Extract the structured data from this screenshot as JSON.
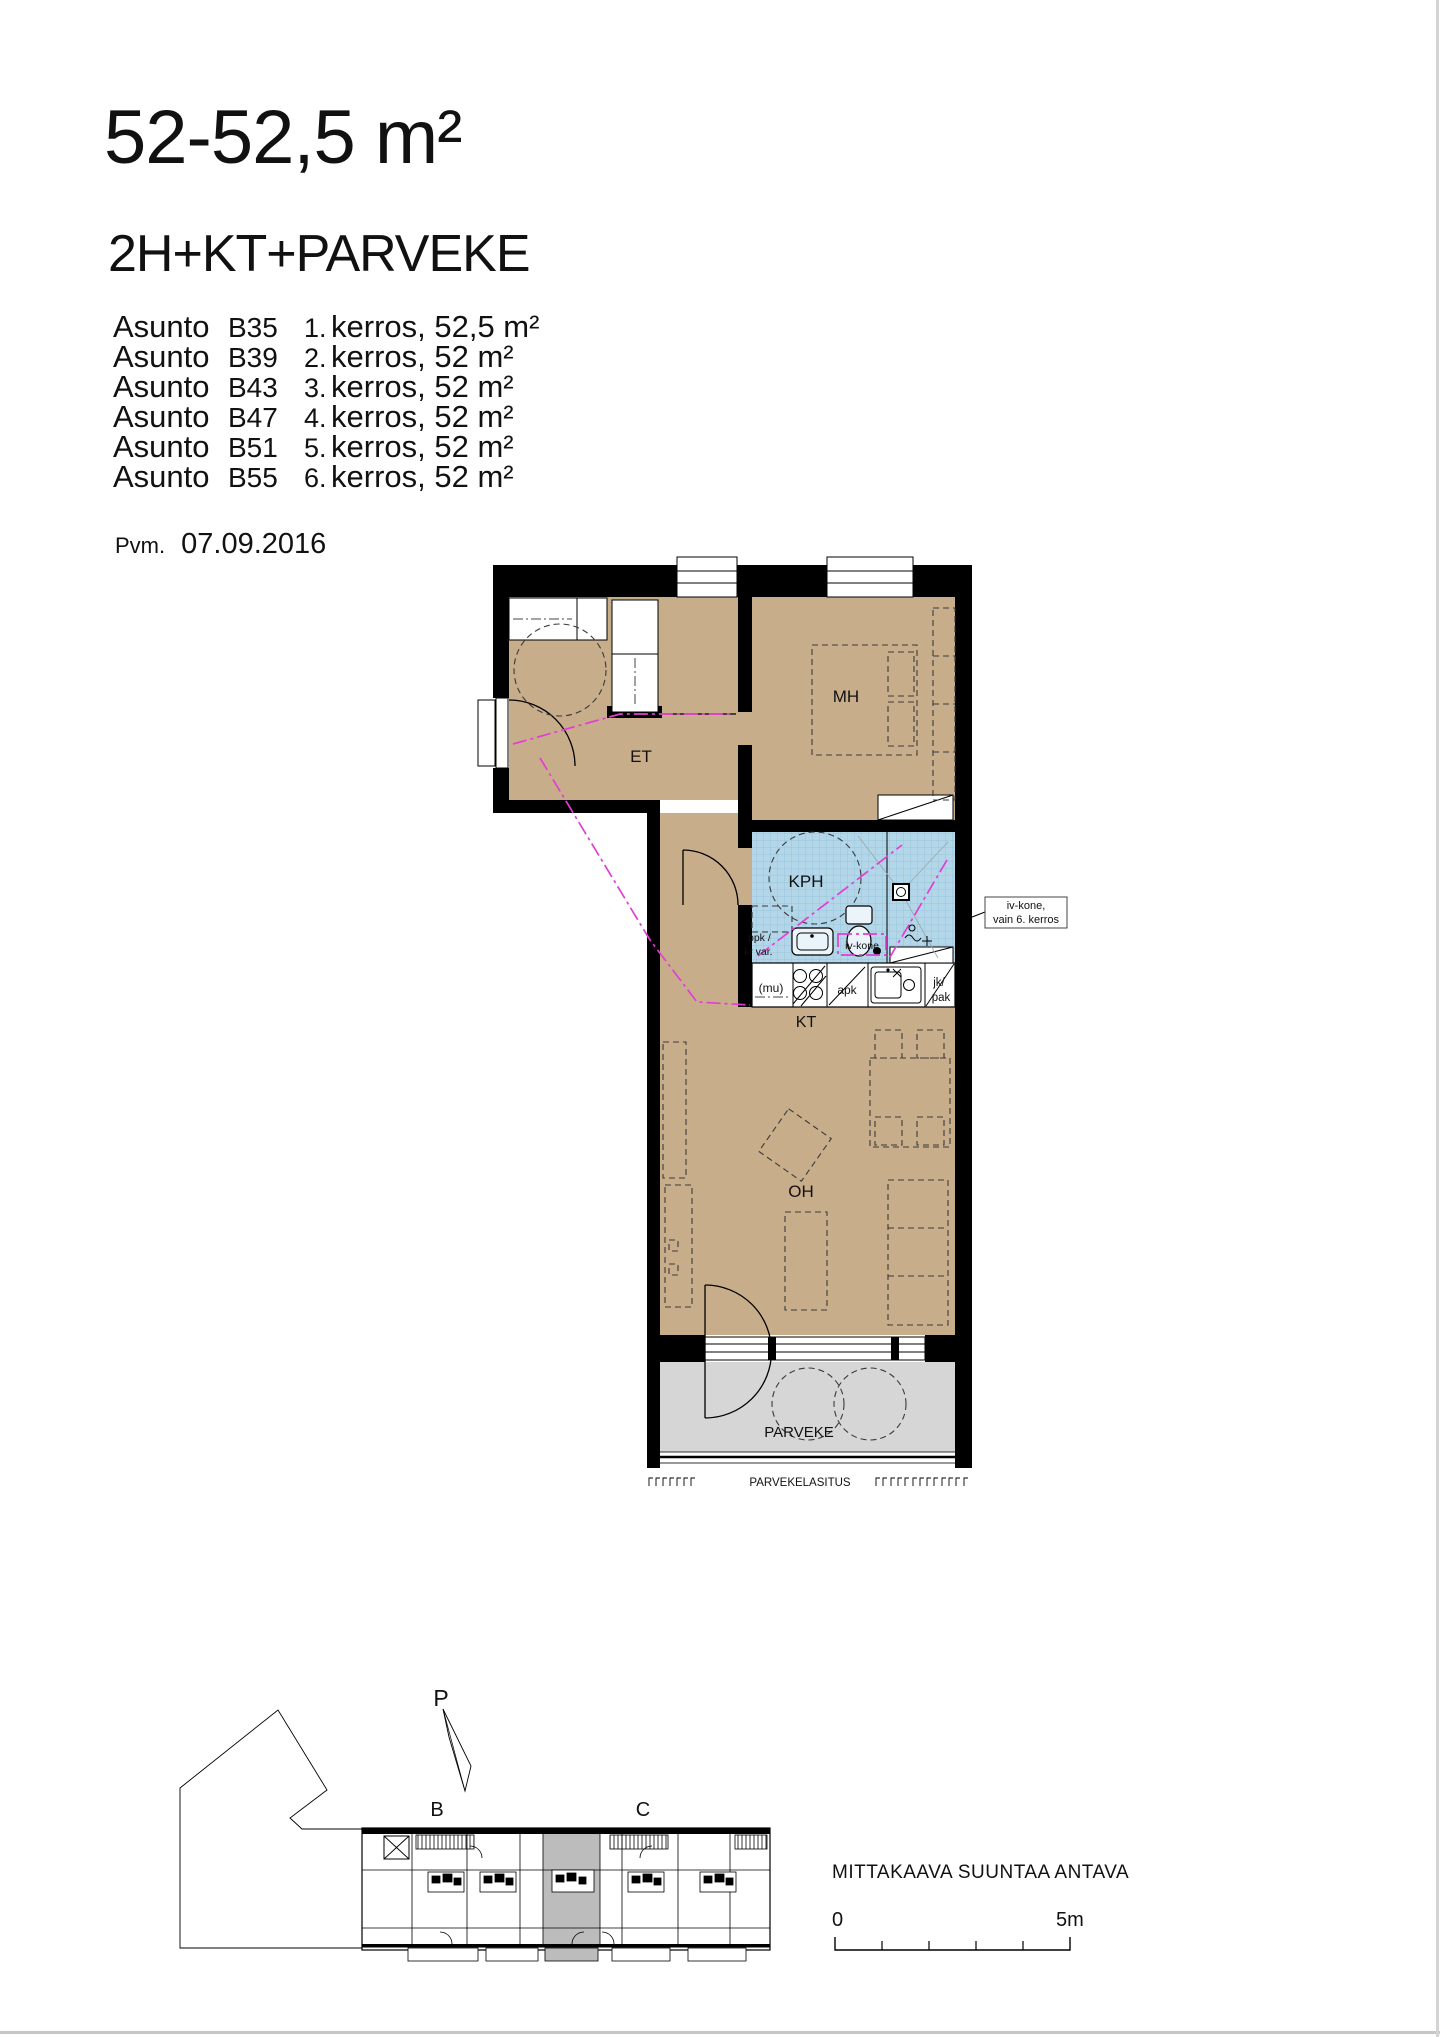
{
  "header": {
    "title": "52-52,5 m²",
    "subtitle": "2H+KT+PARVEKE",
    "list_label": "Asunto",
    "apartments": [
      {
        "unit": "B35",
        "floor": "1.",
        "desc": "kerros, 52,5 m²"
      },
      {
        "unit": "B39",
        "floor": "2.",
        "desc": "kerros, 52 m²"
      },
      {
        "unit": "B43",
        "floor": "3.",
        "desc": "kerros, 52 m²"
      },
      {
        "unit": "B47",
        "floor": "4.",
        "desc": "kerros, 52 m²"
      },
      {
        "unit": "B51",
        "floor": "5.",
        "desc": "kerros, 52 m²"
      },
      {
        "unit": "B55",
        "floor": "6.",
        "desc": "kerros, 52 m²"
      }
    ],
    "date_label": "Pvm.",
    "date": "07.09.2016"
  },
  "plan": {
    "rooms": {
      "et": "ET",
      "mh": "MH",
      "kph": "KPH",
      "kt": "KT",
      "oh": "OH",
      "parveke": "PARVEKE"
    },
    "fixtures": {
      "ppk1": "ppk /",
      "ppk2": "kr var.",
      "iv": "iv-kone",
      "mu": "(mu)",
      "apk": "apk",
      "jk1": "jk/",
      "jk2": "pak"
    },
    "glazing": "PARVEKELASITUS",
    "annotation": {
      "line1": "iv-kone,",
      "line2": "vain 6. kerros"
    }
  },
  "site": {
    "north": "P",
    "building_b": "B",
    "building_c": "C",
    "scale_note": "MITTAKAAVA SUUNTAA ANTAVA",
    "scale_zero": "0",
    "scale_five": "5m"
  },
  "colors": {
    "room": "#c8ad8b",
    "wet": "#b3d6e8",
    "balcony": "#d6d6d6",
    "highlight": "#bcbcbc",
    "magenta": "#e23ed4",
    "wall": "#000000"
  }
}
